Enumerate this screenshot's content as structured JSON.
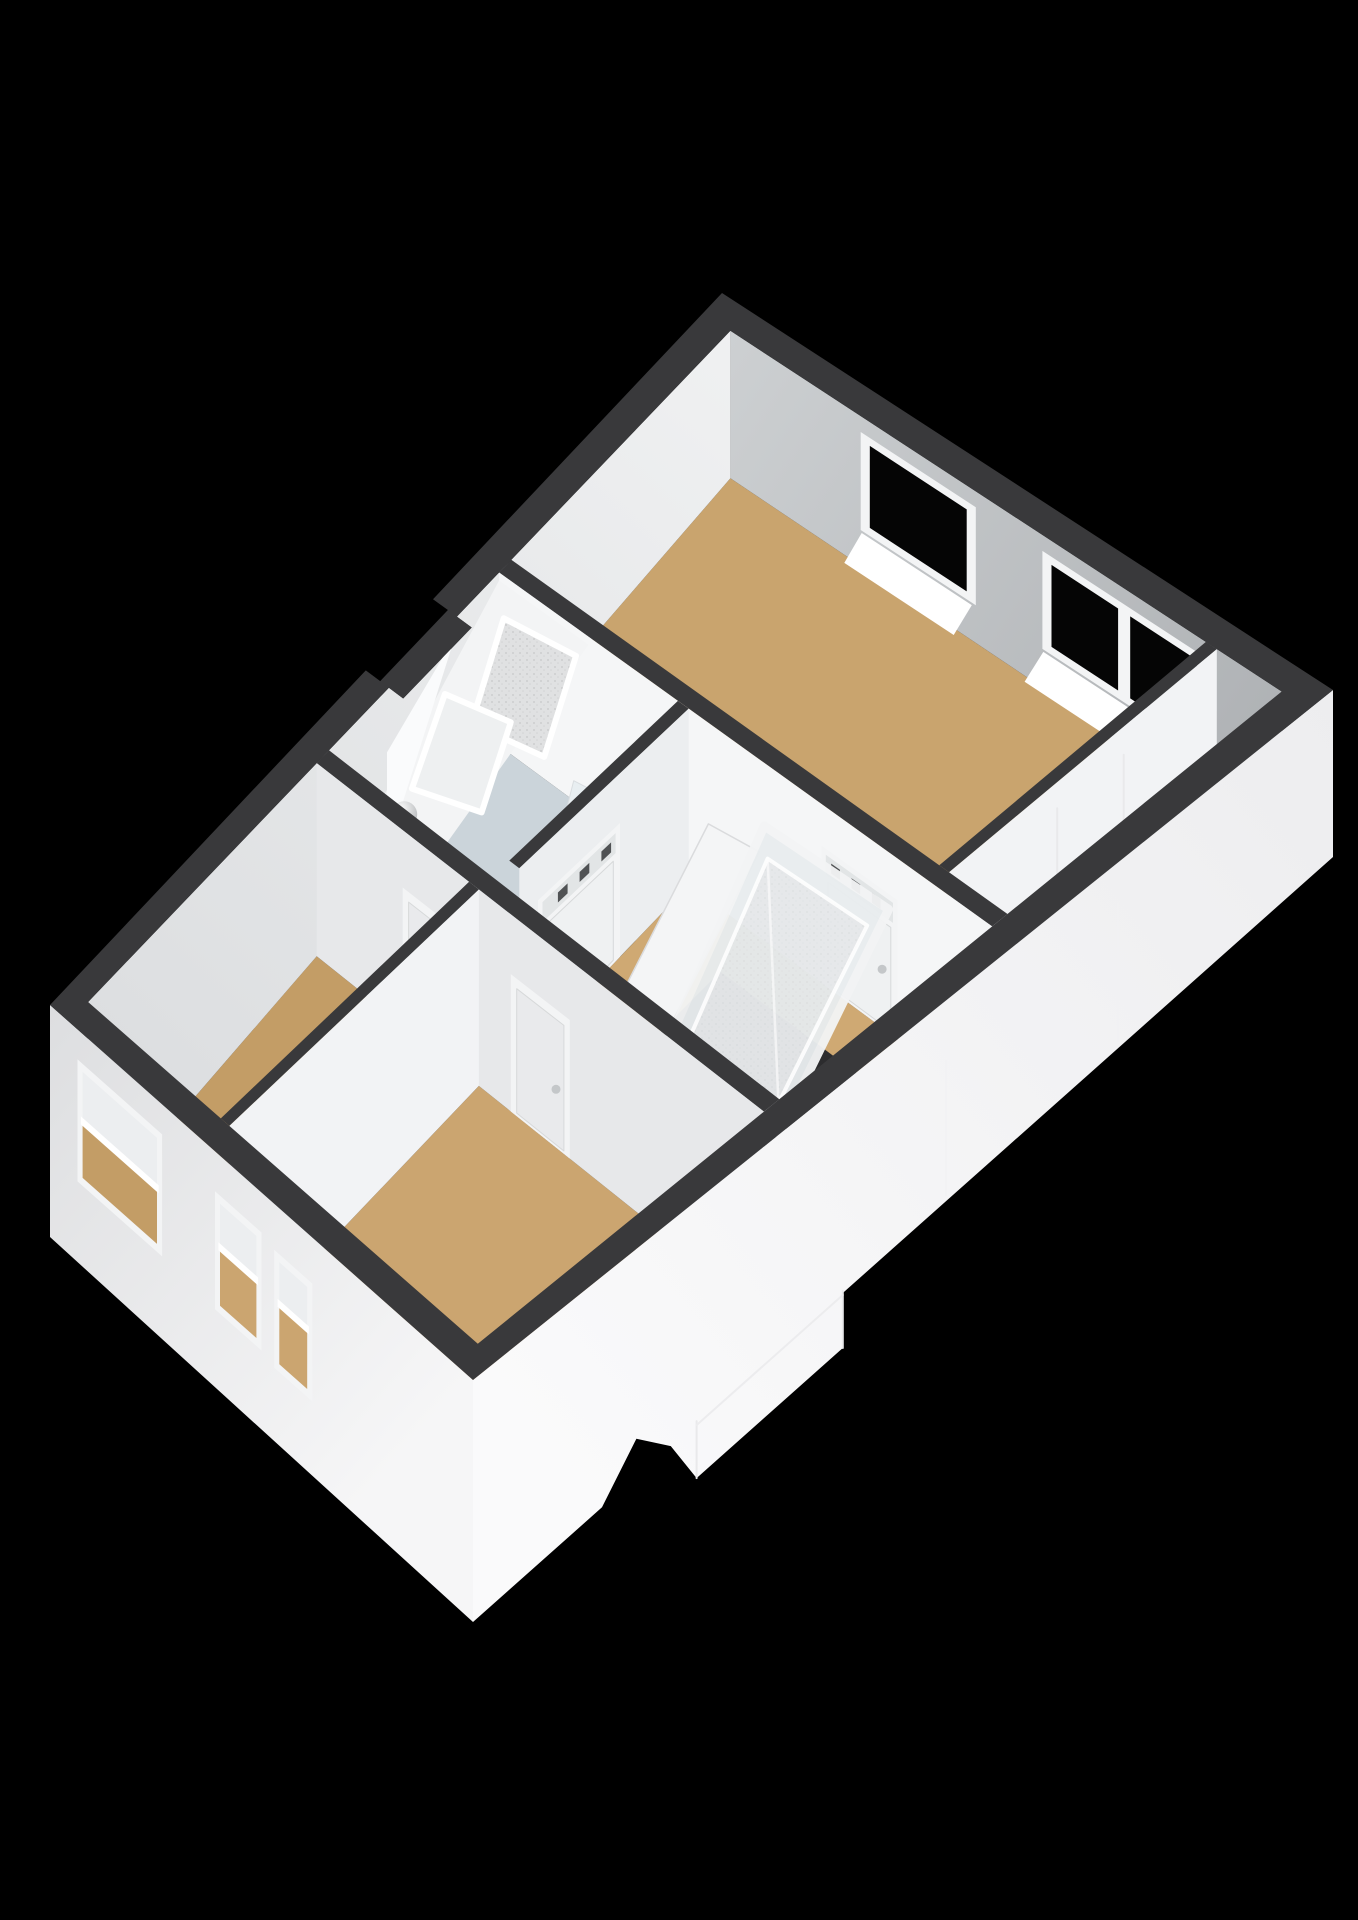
{
  "scene": {
    "description": "Isometric 3D floor plan render of an upper residential floor on a black background",
    "rooms": [
      {
        "id": "master-bedroom",
        "floor": "wood"
      },
      {
        "id": "closet-nook",
        "floor": "wood"
      },
      {
        "id": "bathroom",
        "floor": "pale-tile"
      },
      {
        "id": "landing",
        "floor": "wood"
      },
      {
        "id": "left-bedroom",
        "floor": "wood"
      },
      {
        "id": "bottom-bedroom",
        "floor": "wood"
      }
    ],
    "fixtures": [
      "toilet",
      "sloped-ceiling-skylight",
      "skylight-well",
      "wall-lamp",
      "leaning-roof-window",
      "leaning-door-panel",
      "stair-opening",
      "stair-railing"
    ],
    "windows": {
      "far-facade": 3,
      "near-facade": 3
    },
    "doors": 4
  },
  "colors": {
    "background": "#000000",
    "wall_top": "#39393b",
    "inner_ne_a": "#ced1d3",
    "inner_ne_b": "#aeb1b4",
    "inner_nw_a": "#f0f1f2",
    "inner_nw_b": "#dcdee0",
    "outer_sw_a": "#dddee0",
    "outer_sw_b": "#f6f6f7",
    "outer_se_a": "#fafafb",
    "outer_se_b": "#ededef",
    "wall_lit": "#f5f6f7",
    "wall_mid": "#e7e8ea",
    "wall_soft": "#eceef0",
    "wall_part": "#f2f3f5",
    "floor_master": "#c9a46e",
    "floor_landing": "#cfa973",
    "floor_left": "#c39d66",
    "floor_bottom": "#cba570",
    "floor_nook": "#c09960",
    "floor_bath": "#cbd4da",
    "glass": "#050505",
    "frame": "#f3f4f5",
    "sill": "#ffffff",
    "slope": "#f3f4f5",
    "skylight_b": "#eef0f1",
    "stair_hole": "#2c2c2e",
    "rail": "#fbfbfc",
    "roof_glass": "#e9edef",
    "panel": "#f4f5f6",
    "fixture": "#f7f9fa",
    "fixture_shade": "#e8eef1",
    "fixture_line": "#dfe3e6",
    "leaf": "#eff1f2",
    "leaf_dark": "#e9eaec",
    "handle": "#c4c7c9",
    "transom": "#e2e5e6",
    "transom_slot": "#505254",
    "ball_lo": "#a6a9ac",
    "shadow": "#2e2e30",
    "seam": "#e9e9eb",
    "tray_texture": "#e0e1e2"
  }
}
